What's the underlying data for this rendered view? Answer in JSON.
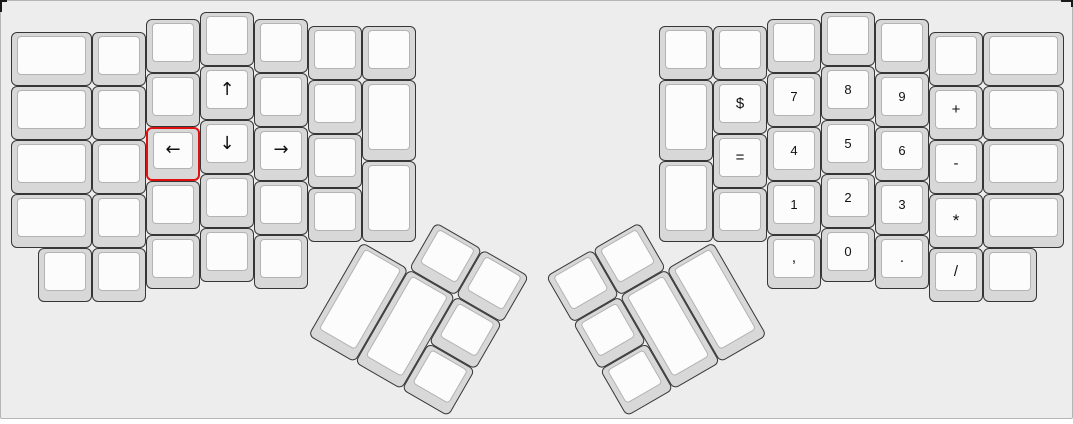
{
  "canvas": {
    "background": "#ededed",
    "page_background": "#ffffff",
    "key_cap_color": "#d8d8d8",
    "key_top_color": "#fcfcfc",
    "key_border_color": "#363636",
    "selected_border_color": "#e01010",
    "label_color": "#111111"
  },
  "keyboard": {
    "unit_px": 54,
    "selected_key_label": "←",
    "halves": [
      {
        "name": "left-keyboard-half",
        "origin_x": 10,
        "origin_y": 11,
        "keys": [
          [
            0,
            0.375,
            1.5,
            1,
            ""
          ],
          [
            0,
            1.375,
            1.5,
            1,
            ""
          ],
          [
            0,
            2.375,
            1.5,
            1,
            ""
          ],
          [
            0,
            3.375,
            1.5,
            1,
            ""
          ],
          [
            1.5,
            0.375,
            1,
            1,
            ""
          ],
          [
            1.5,
            1.375,
            1,
            1,
            ""
          ],
          [
            1.5,
            2.375,
            1,
            1,
            ""
          ],
          [
            1.5,
            3.375,
            1,
            1,
            ""
          ],
          [
            2.5,
            0.125,
            1,
            1,
            ""
          ],
          [
            2.5,
            1.125,
            1,
            1,
            ""
          ],
          [
            2.5,
            2.125,
            1,
            1,
            "←",
            true
          ],
          [
            2.5,
            3.125,
            1,
            1,
            ""
          ],
          [
            3.5,
            0,
            1,
            1,
            ""
          ],
          [
            3.5,
            1,
            1,
            1,
            "↑"
          ],
          [
            3.5,
            2,
            1,
            1,
            "↓"
          ],
          [
            3.5,
            3,
            1,
            1,
            ""
          ],
          [
            4.5,
            0.125,
            1,
            1,
            ""
          ],
          [
            4.5,
            1.125,
            1,
            1,
            ""
          ],
          [
            4.5,
            2.125,
            1,
            1,
            "→"
          ],
          [
            4.5,
            3.125,
            1,
            1,
            ""
          ],
          [
            5.5,
            0.25,
            1,
            1,
            ""
          ],
          [
            5.5,
            1.25,
            1,
            1,
            ""
          ],
          [
            5.5,
            2.25,
            1,
            1,
            ""
          ],
          [
            5.5,
            3.25,
            1,
            1,
            ""
          ],
          [
            6.5,
            0.25,
            1,
            1,
            ""
          ],
          [
            6.5,
            1.25,
            1,
            1.5,
            ""
          ],
          [
            6.5,
            2.75,
            1,
            1.5,
            ""
          ],
          [
            0.5,
            4.375,
            1,
            1,
            ""
          ],
          [
            1.5,
            4.375,
            1,
            1,
            ""
          ],
          [
            2.5,
            4.125,
            1,
            1,
            ""
          ],
          [
            3.5,
            4,
            1,
            1,
            ""
          ],
          [
            4.5,
            4.125,
            1,
            1,
            ""
          ]
        ]
      },
      {
        "name": "right-keyboard-half",
        "origin_x": 658,
        "origin_y": 11,
        "keys": [
          [
            0,
            0.25,
            1,
            1,
            ""
          ],
          [
            0,
            1.25,
            1,
            1.5,
            ""
          ],
          [
            0,
            2.75,
            1,
            1.5,
            ""
          ],
          [
            1,
            0.25,
            1,
            1,
            ""
          ],
          [
            1,
            1.25,
            1,
            1,
            "$"
          ],
          [
            1,
            2.25,
            1,
            1,
            "="
          ],
          [
            1,
            3.25,
            1,
            1,
            ""
          ],
          [
            2,
            0.125,
            1,
            1,
            ""
          ],
          [
            2,
            1.125,
            1,
            1,
            "7"
          ],
          [
            2,
            2.125,
            1,
            1,
            "4"
          ],
          [
            2,
            3.125,
            1,
            1,
            "1"
          ],
          [
            2,
            4.125,
            1,
            1,
            ","
          ],
          [
            3,
            0,
            1,
            1,
            ""
          ],
          [
            3,
            1,
            1,
            1,
            "8"
          ],
          [
            3,
            2,
            1,
            1,
            "5"
          ],
          [
            3,
            3,
            1,
            1,
            "2"
          ],
          [
            3,
            4,
            1,
            1,
            "0"
          ],
          [
            4,
            0.125,
            1,
            1,
            ""
          ],
          [
            4,
            1.125,
            1,
            1,
            "9"
          ],
          [
            4,
            2.125,
            1,
            1,
            "6"
          ],
          [
            4,
            3.125,
            1,
            1,
            "3"
          ],
          [
            4,
            4.125,
            1,
            1,
            "."
          ],
          [
            5,
            0.375,
            1,
            1,
            ""
          ],
          [
            5,
            1.375,
            1,
            1,
            "+"
          ],
          [
            5,
            2.375,
            1,
            1,
            "-"
          ],
          [
            5,
            3.375,
            1,
            1,
            "*"
          ],
          [
            5,
            4.375,
            1,
            1,
            "/"
          ],
          [
            6,
            0.375,
            1.5,
            1,
            ""
          ],
          [
            6,
            1.375,
            1.5,
            1,
            ""
          ],
          [
            6,
            2.375,
            1.5,
            1,
            ""
          ],
          [
            6,
            3.375,
            1.5,
            1,
            ""
          ],
          [
            6,
            4.375,
            1,
            1,
            ""
          ]
        ]
      }
    ],
    "thumb_clusters": [
      {
        "name": "left-thumb-cluster",
        "center_x": 361,
        "center_y": 240.5,
        "angle_deg": 30,
        "keys": [
          [
            1,
            -1,
            1,
            1,
            ""
          ],
          [
            2,
            -1,
            1,
            1,
            ""
          ],
          [
            0,
            0,
            1,
            2,
            ""
          ],
          [
            1,
            0,
            1,
            2,
            ""
          ],
          [
            2,
            0,
            1,
            1,
            ""
          ],
          [
            2,
            1,
            1,
            1,
            ""
          ]
        ]
      },
      {
        "name": "right-thumb-cluster",
        "center_x": 712,
        "center_y": 240.5,
        "angle_deg": -30,
        "keys": [
          [
            -2,
            -1,
            1,
            1,
            ""
          ],
          [
            -3,
            -1,
            1,
            1,
            ""
          ],
          [
            -1,
            0,
            1,
            2,
            ""
          ],
          [
            -2,
            0,
            1,
            2,
            ""
          ],
          [
            -3,
            0,
            1,
            1,
            ""
          ],
          [
            -3,
            1,
            1,
            1,
            ""
          ]
        ]
      }
    ]
  }
}
